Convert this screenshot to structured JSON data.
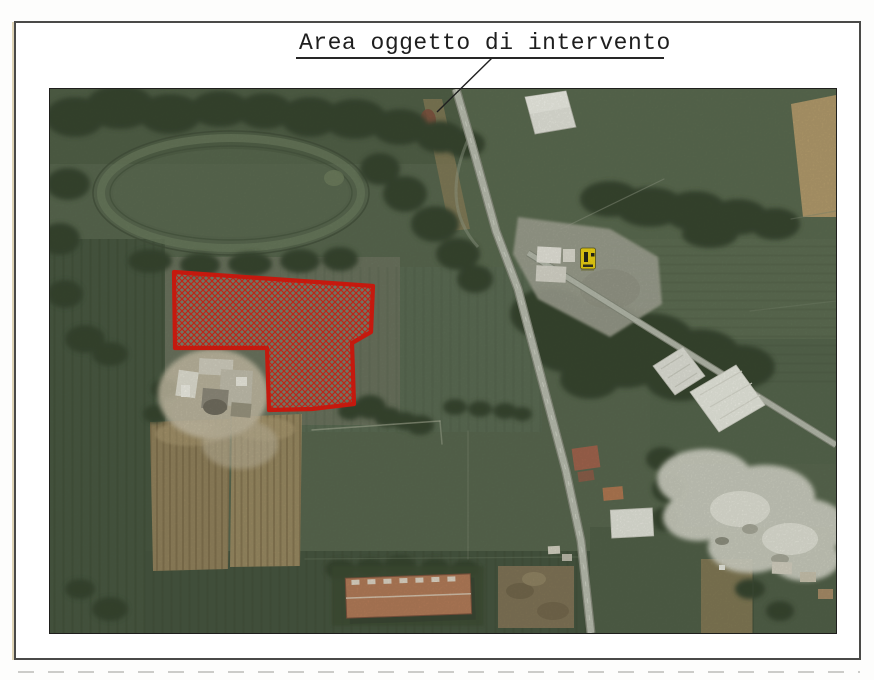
{
  "page": {
    "title": "Area oggetto di intervento"
  },
  "colors": {
    "ink": "#1e1e1e",
    "highlight_red": "#e01208",
    "marker_yellow": "#f2d40b",
    "paper_white": "#ffffff",
    "field_green": "#55644c"
  },
  "map": {
    "kind": "aerial-satellite-photo",
    "annotated_feature": "highlighted-parcel-red-crosshatch",
    "marker": "yellow-map-marker"
  }
}
